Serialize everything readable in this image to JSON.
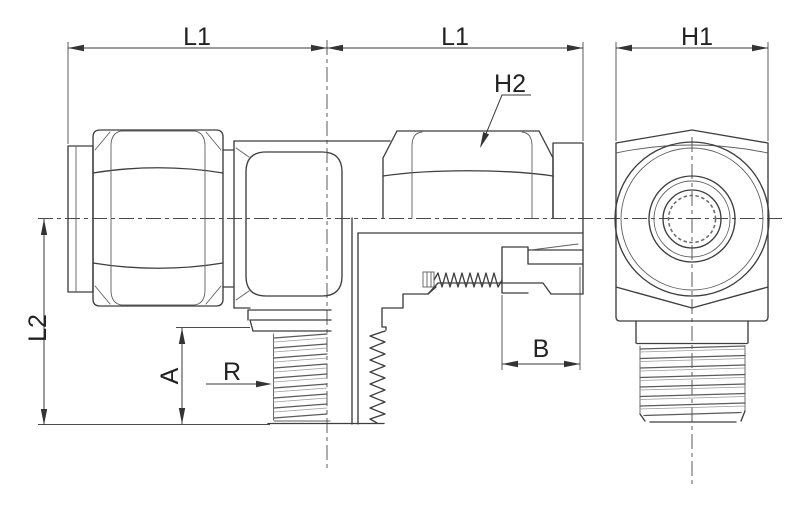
{
  "diagram": {
    "type": "technical-drawing",
    "subject": "male branch tee tube fitting, side half-section view and end view",
    "colors": {
      "background": "#ffffff",
      "line": "#3e3e3e",
      "thread": "#6f6f6f",
      "text": "#222222"
    },
    "labels": {
      "l1_left": "L1",
      "l1_right": "L1",
      "h1": "H1",
      "h2": "H2",
      "l2": "L2",
      "a": "A",
      "r": "R",
      "b": "B"
    }
  }
}
